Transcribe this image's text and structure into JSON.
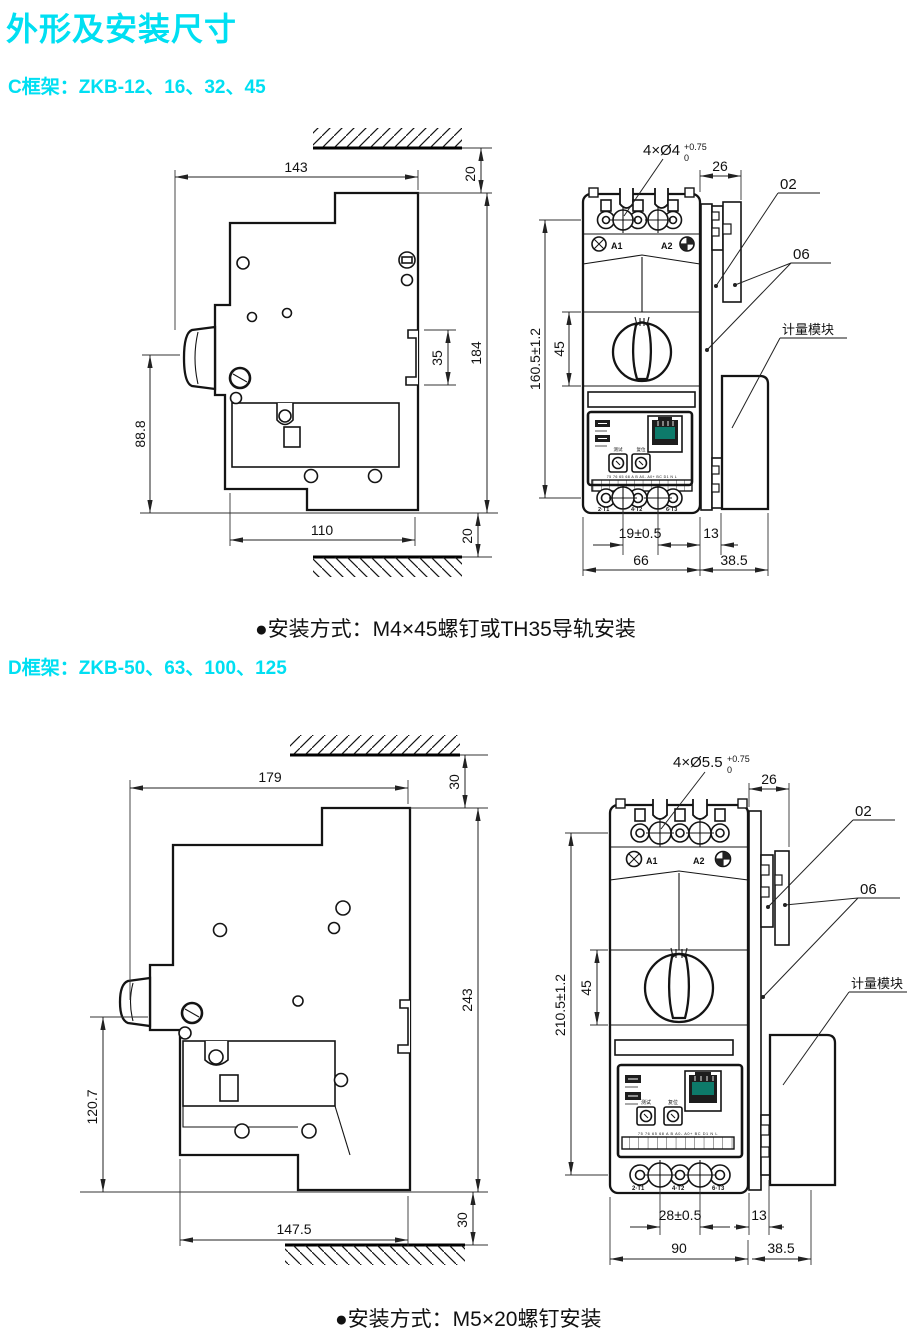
{
  "accent": "#00dff2",
  "title": "外形及安装尺寸",
  "c": {
    "heading": "C框架：ZKB-12、16、32、45",
    "note": "●安装方式：M4×45螺钉或TH35导轨安装",
    "side": {
      "top_width": "143",
      "top_clearance": "20",
      "overall_height": "184",
      "rail_notch": "35",
      "front_height": "88.8",
      "base_width": "110",
      "bottom_clearance": "20"
    },
    "front": {
      "holes": "4×Ø4",
      "holes_tol_upper": "+0.75",
      "holes_tol_lower": "0",
      "top_depth": "26",
      "part_a": "02",
      "part_b": "06",
      "module": "计量模块",
      "overall_height": "160.5±1.2",
      "handle_height": "45",
      "terminal_pitch": "19±0.5",
      "rail_depth": "13",
      "body_width": "66",
      "module_depth": "38.5",
      "coil_a1": "A1",
      "coil_a2": "A2",
      "dial_test": "测试",
      "dial_reset": "复位",
      "strip_labels": "75 76 65 68 A B A0- A0+ BC D1 N L",
      "t1": "2·T1",
      "t2": "4·T2",
      "t3": "6·T3"
    }
  },
  "d": {
    "heading": "D框架：ZKB-50、63、100、125",
    "note": "●安装方式：M5×20螺钉安装",
    "side": {
      "top_width": "179",
      "top_clearance": "30",
      "overall_height": "243",
      "front_height": "120.7",
      "base_width": "147.5",
      "bottom_clearance": "30"
    },
    "front": {
      "holes": "4×Ø5.5",
      "holes_tol_upper": "+0.75",
      "holes_tol_lower": "0",
      "top_depth": "26",
      "part_a": "02",
      "part_b": "06",
      "module": "计量模块",
      "overall_height": "210.5±1.2",
      "handle_height": "45",
      "terminal_pitch": "28±0.5",
      "rail_depth": "13",
      "body_width": "90",
      "module_depth": "38.5",
      "coil_a1": "A1",
      "coil_a2": "A2",
      "dial_test": "测试",
      "dial_reset": "复位",
      "strip_labels": "75 76 65 68 A B A0- A0+ BC D1 N L",
      "t1": "2·T1",
      "t2": "4·T2",
      "t3": "6·T3"
    }
  }
}
